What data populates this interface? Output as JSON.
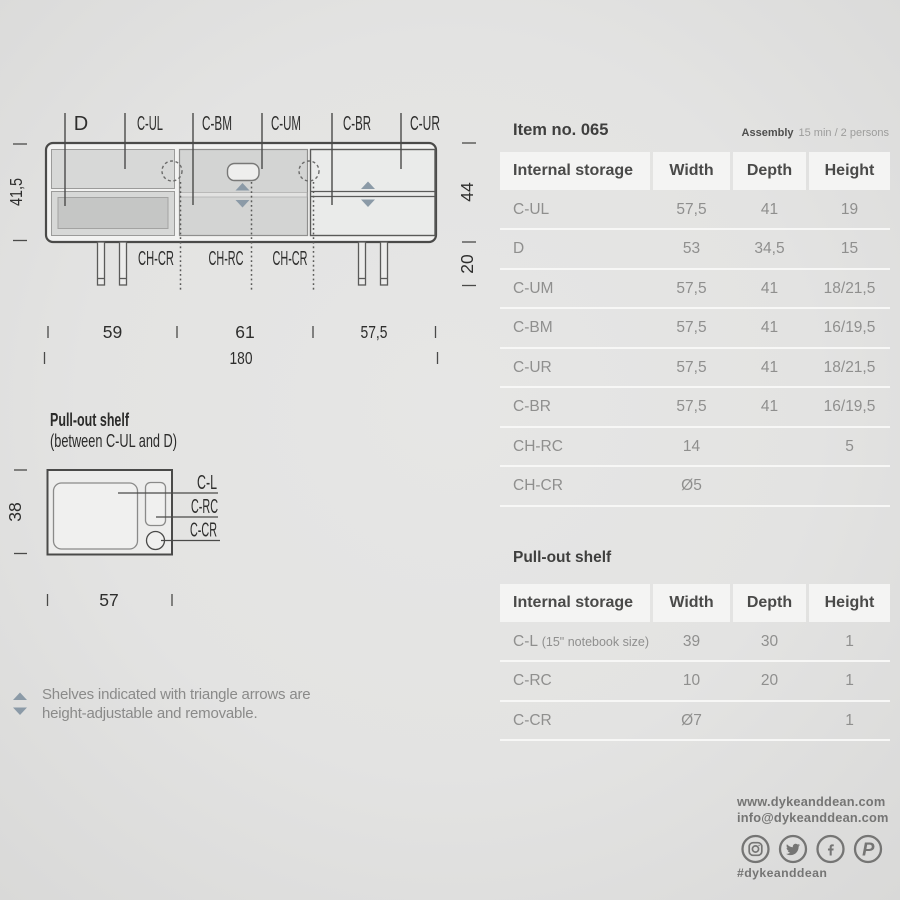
{
  "colors": {
    "background": "#e3e3e2",
    "line": "#4a4a49",
    "accent_triangle": "#8b9aa7",
    "table_header_bg": "#f4f4f3",
    "table_text": "#8f8f8e",
    "dark_text": "#3f3f3e",
    "footer_text": "#757574"
  },
  "diagram": {
    "cabinet": {
      "top_labels": [
        "D",
        "C-UL",
        "C-BM",
        "C-UM",
        "C-BR",
        "C-UR"
      ],
      "bottom_labels": [
        "CH-CR",
        "CH-RC",
        "CH-CR"
      ],
      "dim_left": "41,5",
      "dim_right_body": "44",
      "dim_right_legs": "20",
      "dim_widths": [
        "59",
        "61",
        "57,5"
      ],
      "dim_total": "180"
    },
    "pullout": {
      "title": "Pull-out shelf",
      "subtitle": "(between C-UL and D)",
      "dim_left": "38",
      "dim_bottom": "57",
      "labels": [
        "C-L",
        "C-RC",
        "C-CR"
      ]
    },
    "note": {
      "line1": "Shelves indicated with triangle arrows are",
      "line2": "height-adjustable and removable."
    }
  },
  "panel": {
    "item_title": "Item no. 065",
    "assembly_label": "Assembly",
    "assembly_value": "15 min / 2 persons",
    "table1": {
      "headers": [
        "Internal storage",
        "Width",
        "Depth",
        "Height"
      ],
      "rows": [
        {
          "label": "C-UL",
          "width": "57,5",
          "depth": "41",
          "height": "19"
        },
        {
          "label": "D",
          "width": "53",
          "depth": "34,5",
          "height": "15"
        },
        {
          "label": "C-UM",
          "width": "57,5",
          "depth": "41",
          "height": "18/21,5"
        },
        {
          "label": "C-BM",
          "width": "57,5",
          "depth": "41",
          "height": "16/19,5"
        },
        {
          "label": "C-UR",
          "width": "57,5",
          "depth": "41",
          "height": "18/21,5"
        },
        {
          "label": "C-BR",
          "width": "57,5",
          "depth": "41",
          "height": "16/19,5"
        },
        {
          "label": "CH-RC",
          "width": "14",
          "depth": "",
          "height": "5"
        },
        {
          "label": "CH-CR",
          "width": "Ø5",
          "depth": "",
          "height": ""
        }
      ]
    },
    "table2": {
      "title": "Pull-out shelf",
      "headers": [
        "Internal storage",
        "Width",
        "Depth",
        "Height"
      ],
      "rows": [
        {
          "label": "C-L",
          "note": "(15\" notebook size)",
          "width": "39",
          "depth": "30",
          "height": "1"
        },
        {
          "label": "C-RC",
          "note": "",
          "width": "10",
          "depth": "20",
          "height": "1"
        },
        {
          "label": "C-CR",
          "note": "",
          "width": "Ø7",
          "depth": "",
          "height": "1"
        }
      ]
    }
  },
  "footer": {
    "website": "www.dykeanddean.com",
    "email": "info@dykeanddean.com",
    "hashtag": "#dykeanddean",
    "icons": [
      "instagram-icon",
      "twitter-icon",
      "facebook-icon",
      "pinterest-icon"
    ]
  }
}
